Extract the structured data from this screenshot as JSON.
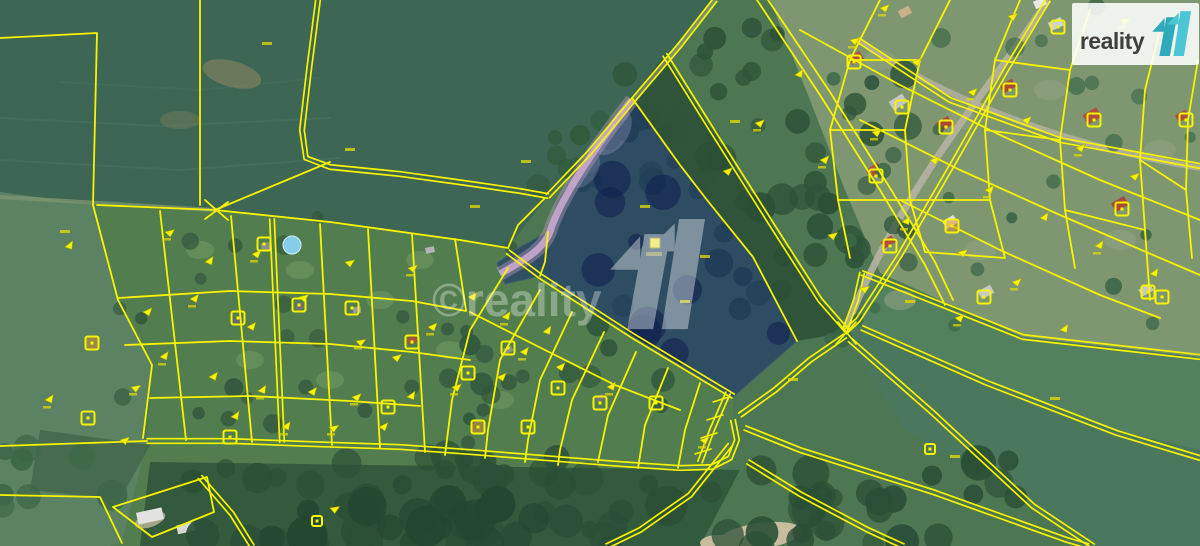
{
  "logo": {
    "text": "reality",
    "mark_icon": "11-logo-icon",
    "mark_color_dark": "#2fa9bb",
    "mark_color_light": "#4cc6d4",
    "text_color": "#3f3f3f",
    "background": "#ffffff"
  },
  "watermark": {
    "text": "©reality",
    "mark_icon": "11-logo-icon",
    "color": "#ffffff"
  },
  "map": {
    "type": "satellite-cadastral-view",
    "parcel_line_color": "#f8f400",
    "highlighted_parcel": {
      "fill_color": "#19306f",
      "marker_icon": "parcel-marker-icon"
    },
    "icons": [
      "11-logo-icon",
      "parcel-marker-icon",
      "building-outline-icon",
      "flag-marker-icon",
      "swimming-pool-icon"
    ]
  }
}
